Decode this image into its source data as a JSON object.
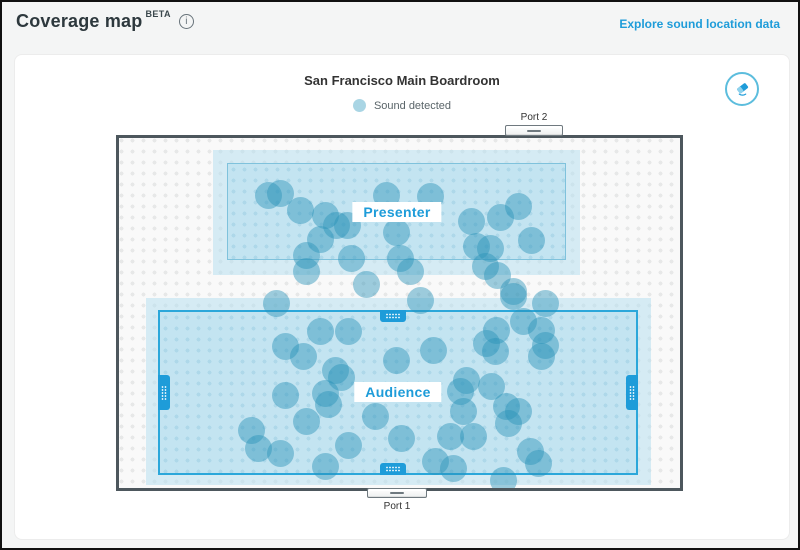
{
  "header": {
    "title": "Coverage map",
    "beta_badge": "BETA",
    "link": "Explore sound location data"
  },
  "icons": {
    "info_glyph": "i"
  },
  "panel": {
    "title": "San Francisco Main Boardroom",
    "legend_label": "Sound detected"
  },
  "room": {
    "ports": {
      "top": "Port 2",
      "bottom": "Port 1"
    },
    "zones": {
      "presenter": "Presenter",
      "audience": "Audience"
    }
  },
  "colors": {
    "accent_teal": "#1e9cd9",
    "dot_fill": "#2a93b8",
    "zone_border": "#2ba7da",
    "legend_dot": "#a9d5e4",
    "wall": "#4d575d"
  },
  "chart_data": {
    "type": "scatter",
    "title": "Sound detected locations (room coordinates, px)",
    "sound_dots": [
      [
        152,
        60
      ],
      [
        164,
        58
      ],
      [
        184,
        75
      ],
      [
        209,
        80
      ],
      [
        220,
        90
      ],
      [
        231,
        90
      ],
      [
        204,
        104
      ],
      [
        270,
        60
      ],
      [
        314,
        61
      ],
      [
        280,
        97
      ],
      [
        355,
        86
      ],
      [
        384,
        82
      ],
      [
        402,
        71
      ],
      [
        360,
        111
      ],
      [
        374,
        113
      ],
      [
        415,
        105
      ],
      [
        190,
        120
      ],
      [
        235,
        123
      ],
      [
        284,
        123
      ],
      [
        190,
        136
      ],
      [
        250,
        149
      ],
      [
        294,
        136
      ],
      [
        369,
        131
      ],
      [
        381,
        140
      ],
      [
        397,
        156
      ],
      [
        429,
        168
      ],
      [
        160,
        168
      ],
      [
        304,
        165
      ],
      [
        204,
        196
      ],
      [
        232,
        196
      ],
      [
        169,
        211
      ],
      [
        187,
        221
      ],
      [
        219,
        235
      ],
      [
        225,
        242
      ],
      [
        209,
        258
      ],
      [
        212,
        269
      ],
      [
        169,
        260
      ],
      [
        190,
        286
      ],
      [
        135,
        295
      ],
      [
        142,
        313
      ],
      [
        164,
        318
      ],
      [
        209,
        331
      ],
      [
        232,
        310
      ],
      [
        259,
        281
      ],
      [
        280,
        225
      ],
      [
        285,
        303
      ],
      [
        317,
        215
      ],
      [
        334,
        301
      ],
      [
        387,
        345
      ],
      [
        380,
        195
      ],
      [
        397,
        161
      ],
      [
        407,
        186
      ],
      [
        425,
        195
      ],
      [
        370,
        208
      ],
      [
        379,
        216
      ],
      [
        429,
        210
      ],
      [
        425,
        221
      ],
      [
        350,
        245
      ],
      [
        344,
        256
      ],
      [
        375,
        251
      ],
      [
        390,
        271
      ],
      [
        402,
        276
      ],
      [
        347,
        276
      ],
      [
        392,
        288
      ],
      [
        357,
        301
      ],
      [
        414,
        316
      ],
      [
        422,
        328
      ],
      [
        319,
        326
      ],
      [
        337,
        333
      ]
    ]
  }
}
